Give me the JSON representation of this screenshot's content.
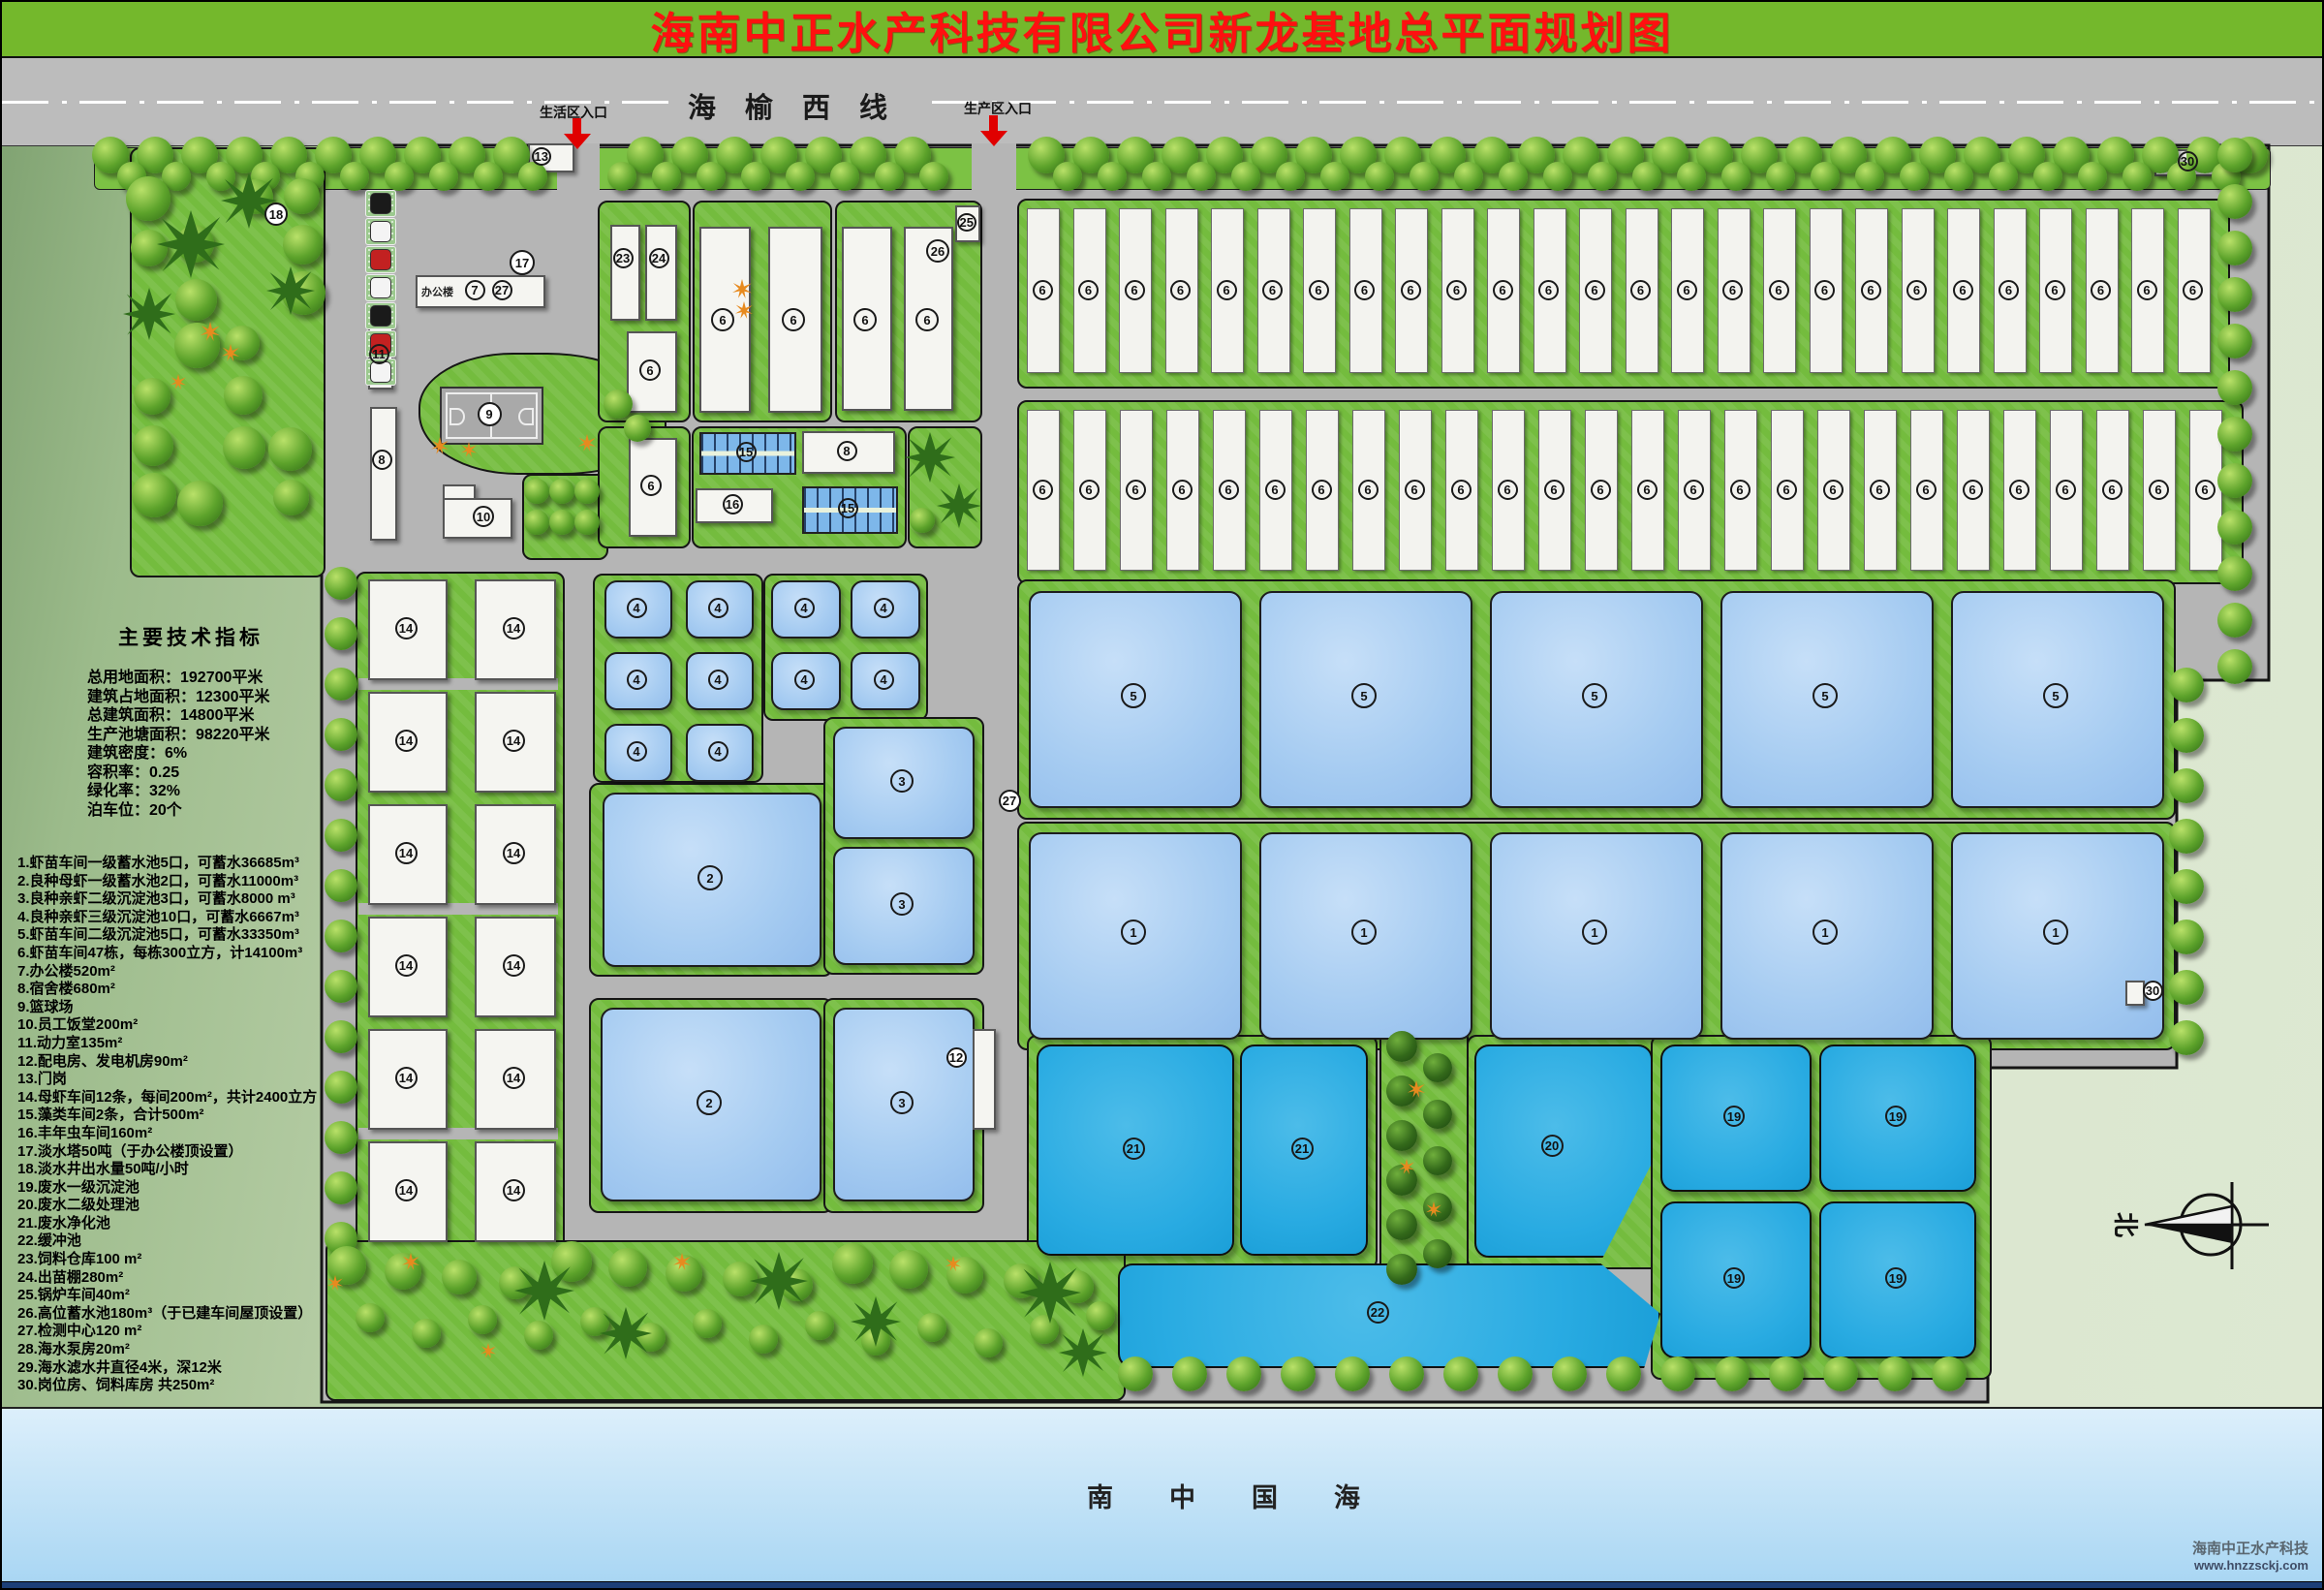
{
  "header": {
    "title": "海南中正水产科技有限公司新龙基地总平面规划图"
  },
  "highway": {
    "name": "海榆西线",
    "entrance_left": "生活区入口",
    "entrance_right": "生产区入口"
  },
  "tech_indicators": {
    "title": "主要技术指标",
    "lines": [
      "总用地面积：192700平米",
      "建筑占地面积：12300平米",
      "总建筑面积：14800平米",
      "生产池塘面积：98220平米",
      "建筑密度：6%",
      "容积率：0.25",
      "绿化率：32%",
      "泊车位：20个"
    ]
  },
  "legend": [
    "1.虾苗车间一级蓄水池5口，可蓄水36685m³",
    "2.良种母虾一级蓄水池2口，可蓄水11000m³",
    "3.良种亲虾二级沉淀池3口，可蓄水8000 m³",
    "4.良种亲虾三级沉淀池10口，可蓄水6667m³",
    "5.虾苗车间二级沉淀池5口，可蓄水33350m³",
    "6.虾苗车间47栋，每栋300立方，计14100m³",
    "7.办公楼520m²",
    "8.宿舍楼680m²",
    "9.篮球场",
    "10.员工饭堂200m²",
    "11.动力室135m²",
    "12.配电房、发电机房90m²",
    "13.门岗",
    "14.母虾车间12条，每间200m²，共计2400立方",
    "15.藻类车间2条，合计500m²",
    "16.丰年虫车间160m²",
    "17.淡水塔50吨（于办公楼顶设置）",
    "18.淡水井出水量50吨/小时",
    "19.废水一级沉淀池",
    "20.废水二级处理池",
    "21.废水净化池",
    "22.缓冲池",
    "23.饲料仓库100 m²",
    "24.出苗棚280m²",
    "25.锅炉车间40m²",
    "26.高位蓄水池180m³（于已建车间屋顶设置）",
    "27.检测中心120 m²",
    "28.海水泵房20m²",
    "29.海水滤水井直径4米，深12米",
    "30.岗位房、饲料库房 共250m²"
  ],
  "map": {
    "office_label": "办公楼",
    "sea_label": "南中国海",
    "north_label": "北",
    "numbers": {
      "1": "1",
      "2": "2",
      "3": "3",
      "4": "4",
      "5": "5",
      "6": "6",
      "7": "7",
      "8": "8",
      "9": "9",
      "10": "10",
      "11": "11",
      "12": "12",
      "13": "13",
      "14": "14",
      "15": "15",
      "16": "16",
      "17": "17",
      "18": "18",
      "19": "19",
      "20": "20",
      "21": "21",
      "22": "22",
      "23": "23",
      "24": "24",
      "25": "25",
      "26": "26",
      "27": "27",
      "28": "28",
      "29": "29",
      "30": "30"
    }
  },
  "watermark": {
    "line1": "海南中正水产科技",
    "line2": "www.hnzzsckj.com"
  },
  "colors": {
    "header_green": "#74b82c",
    "title_red": "#ff1010",
    "road_gray": "#b5b5b5",
    "grass_green": "#74bc3e",
    "pond_light": "#a5cbf1",
    "pond_bright": "#29abe2",
    "entrance_arrow_red": "#e00000",
    "sea_top": "#dceffb",
    "sea_bottom": "#a9d6f3",
    "footer_navy": "#1c3f77"
  }
}
